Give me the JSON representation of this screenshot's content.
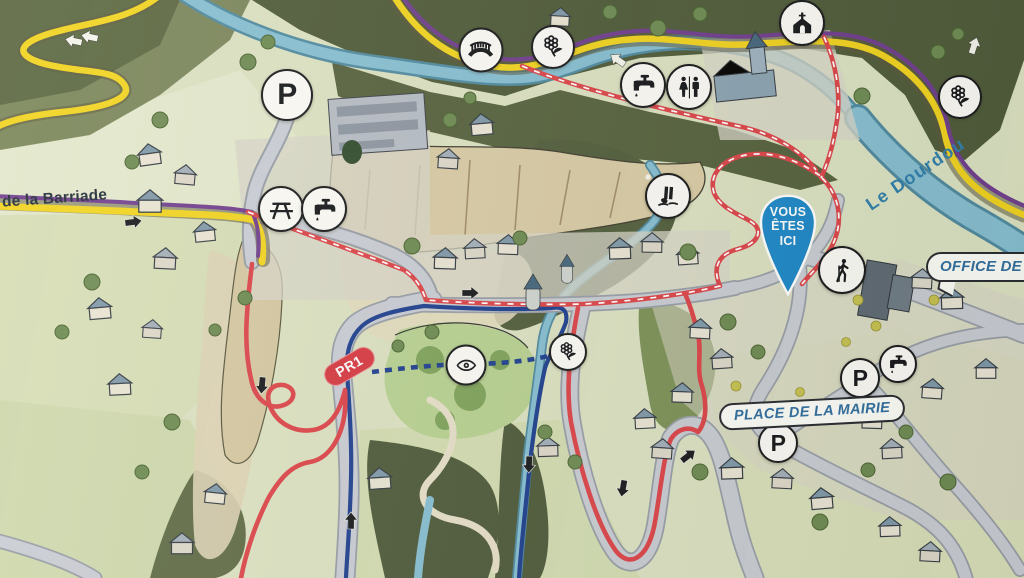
{
  "labels": {
    "you_are_here": {
      "l1": "VOUS",
      "l2": "ÊTES",
      "l3": "ICI"
    },
    "office_tourisme": "OFFICE DE TOUR",
    "place_mairie": "PLACE DE LA MAIRIE",
    "street_barriade": "de la Barriade",
    "river_dourdou": "Le Dourdou",
    "trail_pr1": "PR1"
  },
  "colors": {
    "route_red": "#dc4348",
    "route_blue": "#1d3e8e",
    "road_yellow": "#f2d41e",
    "trail_purple": "#6f3d8e",
    "river_blue": "#86bfd2",
    "pin_blue": "#1b87c8",
    "label_blue": "#2e6d9e",
    "pill_red": "#d63840",
    "circle_bg": "#fbfaf6"
  },
  "markers": [
    {
      "icon": "parking-icon",
      "type": "parking",
      "x": 287,
      "y": 95,
      "size": 52
    },
    {
      "icon": "picnic-table-icon",
      "type": "picnic",
      "x": 281,
      "y": 209,
      "size": 46
    },
    {
      "icon": "water-tap-icon",
      "type": "tap",
      "x": 324,
      "y": 209,
      "size": 46
    },
    {
      "icon": "bridge-icon",
      "type": "bridge",
      "x": 481,
      "y": 50,
      "size": 45
    },
    {
      "icon": "flower-icon",
      "type": "flower",
      "x": 553,
      "y": 47,
      "size": 44
    },
    {
      "icon": "water-tap-icon",
      "type": "tap",
      "x": 643,
      "y": 85,
      "size": 46
    },
    {
      "icon": "toilets-icon",
      "type": "toilets",
      "x": 689,
      "y": 87,
      "size": 46
    },
    {
      "icon": "church-icon",
      "type": "church",
      "x": 802,
      "y": 23,
      "size": 46
    },
    {
      "icon": "flower-icon",
      "type": "flower",
      "x": 960,
      "y": 97,
      "size": 44
    },
    {
      "icon": "waterfall-icon",
      "type": "waterfall",
      "x": 668,
      "y": 196,
      "size": 46
    },
    {
      "icon": "viewpoint-eye-icon",
      "type": "eye",
      "x": 466,
      "y": 365,
      "size": 41
    },
    {
      "icon": "flower-icon",
      "type": "flower",
      "x": 568,
      "y": 352,
      "size": 38
    },
    {
      "icon": "hiker-icon",
      "type": "hiker",
      "x": 842,
      "y": 270,
      "size": 48
    },
    {
      "icon": "water-tap-icon",
      "type": "tap",
      "x": 898,
      "y": 364,
      "size": 38
    },
    {
      "icon": "parking-icon",
      "type": "parking",
      "x": 860,
      "y": 378,
      "size": 40
    },
    {
      "icon": "parking-icon",
      "type": "parking",
      "x": 778,
      "y": 443,
      "size": 40
    }
  ],
  "arrows": [
    {
      "x": 133,
      "y": 222,
      "angle": -8,
      "color": "black"
    },
    {
      "x": 470,
      "y": 293,
      "angle": 0,
      "color": "black"
    },
    {
      "x": 262,
      "y": 385,
      "angle": 95,
      "color": "black"
    },
    {
      "x": 351,
      "y": 521,
      "angle": -90,
      "color": "black"
    },
    {
      "x": 529,
      "y": 464,
      "angle": 92,
      "color": "black"
    },
    {
      "x": 623,
      "y": 488,
      "angle": 100,
      "color": "black"
    },
    {
      "x": 688,
      "y": 456,
      "angle": -38,
      "color": "black"
    },
    {
      "x": 74,
      "y": 41,
      "angle": 192,
      "color": "white"
    },
    {
      "x": 90,
      "y": 37,
      "angle": 192,
      "color": "white"
    },
    {
      "x": 618,
      "y": 60,
      "angle": 215,
      "color": "white"
    },
    {
      "x": 974,
      "y": 46,
      "angle": -72,
      "color": "white"
    }
  ]
}
